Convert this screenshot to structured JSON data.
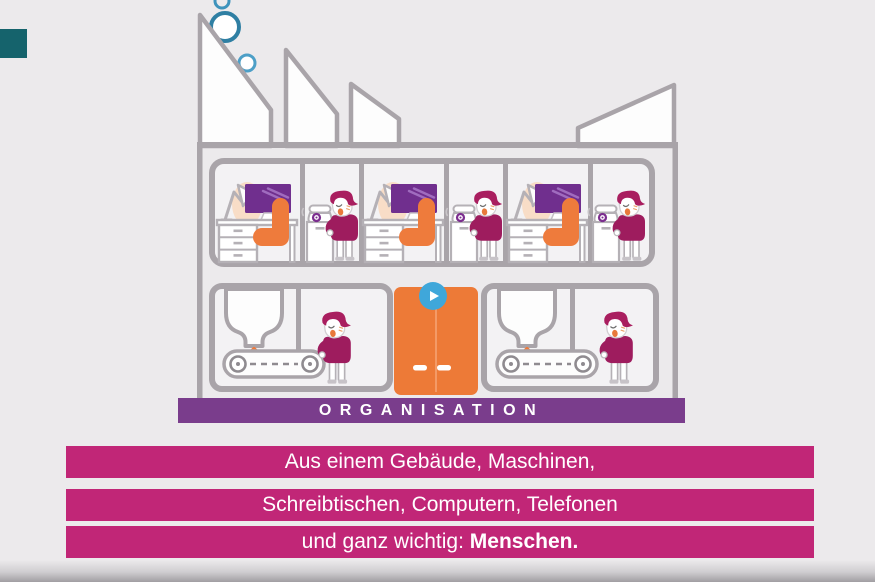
{
  "illustration": {
    "building_label": "ORGANISATION",
    "elements": [
      "smoke-bubbles",
      "sawtooth-factory-roof",
      "office-floor-with-desks-computers-phones-workers",
      "factory-floor-with-hopper-machines-conveyor-belts-workers",
      "orange-double-door"
    ]
  },
  "captions": {
    "line1": "Aus einem Gebäude, Maschinen,",
    "line2": "Schreibtischen, Computern, Telefonen",
    "line3_prefix": "und ganz wichtig: ",
    "line3_emphasis": "Menschen."
  },
  "player": {
    "play_icon": "▶"
  },
  "colors": {
    "background": "#ECEAEC",
    "building_outline": "#A9A4A9",
    "accent_orange": "#EE7B3C",
    "worker_magenta": "#9E1C5E",
    "monitor_purple": "#702F8E",
    "banner_purple": "#7A3D8C",
    "caption_bar_magenta": "#C12677",
    "play_button_blue": "#3FA7DA",
    "bubble_teal": "#2F7FA3",
    "corner_teal": "#15636C"
  }
}
